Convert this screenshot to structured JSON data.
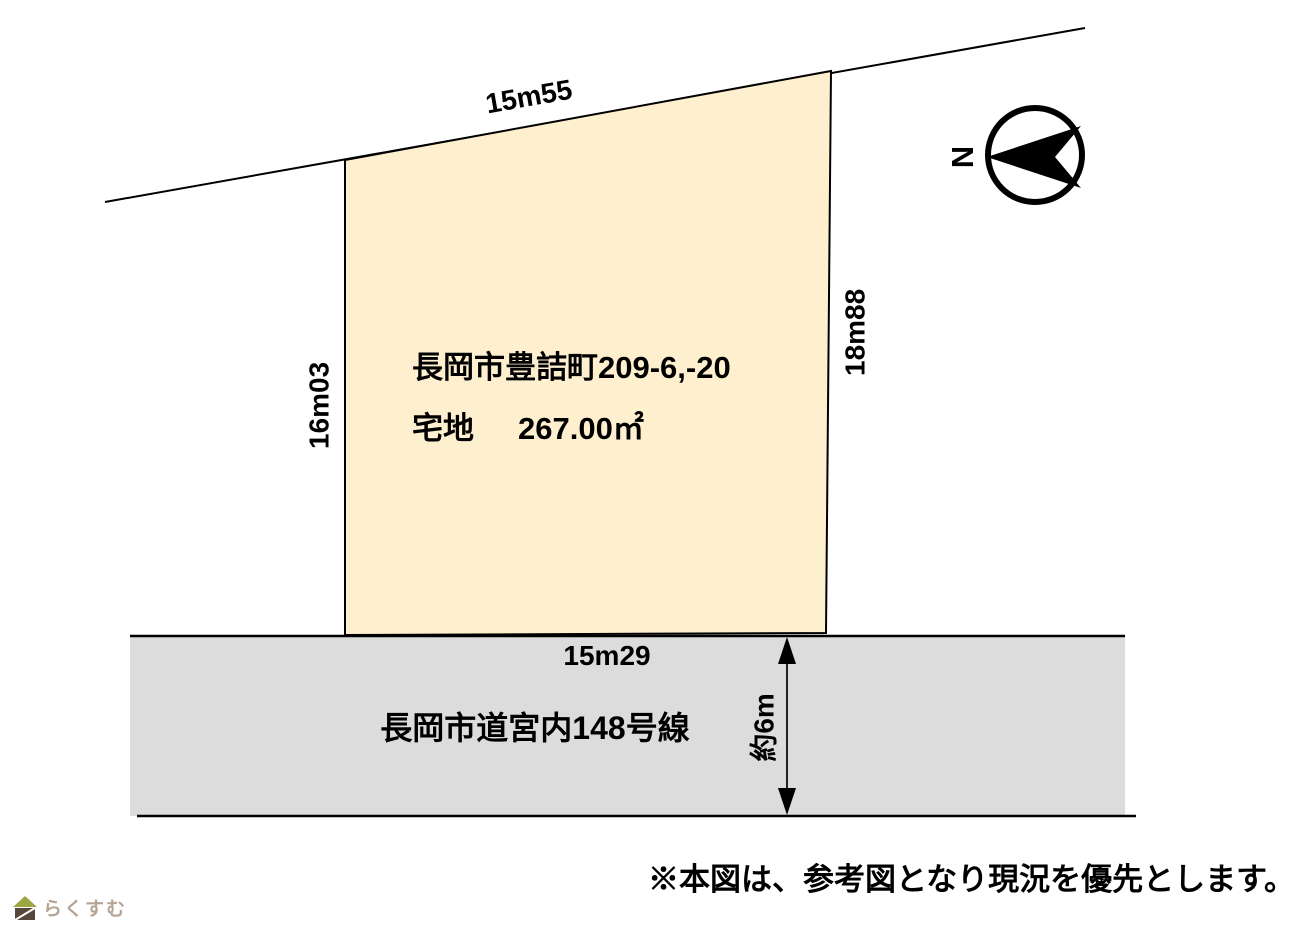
{
  "diagram": {
    "compass": {
      "label": "N"
    },
    "parcel": {
      "address": "長岡市豊詰町209-6,-20",
      "land_type": "宅地",
      "area": "267.00㎡",
      "fill_color": "#FEF0CE"
    },
    "dimensions": {
      "top": "15m55",
      "left": "16m03",
      "right": "18m88",
      "bottom": "15m29"
    },
    "road": {
      "name": "長岡市道宮内148号線",
      "width_label": "約6m",
      "fill_color": "#DCDCDC"
    },
    "note": "※本図は、参考図となり現況を優先とします。",
    "logo": {
      "text": "らくすむ",
      "roof_color": "#9aa83f",
      "body_color": "#57463c",
      "text_color": "#b5a496"
    }
  }
}
